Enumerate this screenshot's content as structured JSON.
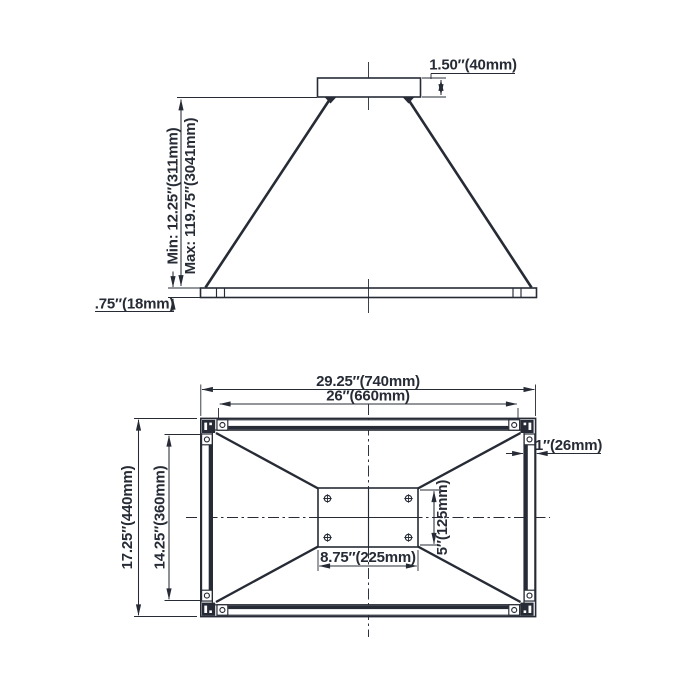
{
  "colors": {
    "ink": "#262b35",
    "background": "#ffffff"
  },
  "side_view": {
    "name": "pendant side elevation",
    "labels": {
      "canopy_height": "1.50″(40mm)",
      "min_height": "Min: 12.25″(311mm)",
      "max_height": "Max: 119.75″(3041mm)",
      "frame_profile_height": ".75″(18mm)"
    }
  },
  "plan_view": {
    "name": "fixture plan view",
    "labels": {
      "outer_width": "29.25″(740mm)",
      "inner_width": "26″(660mm)",
      "outer_depth": "17.25″(440mm)",
      "inner_depth": "14.25″(360mm)",
      "frame_thickness": "1″(26mm)",
      "canopy_width": "8.75″(225mm)",
      "canopy_depth": "5″(125mm)"
    }
  }
}
